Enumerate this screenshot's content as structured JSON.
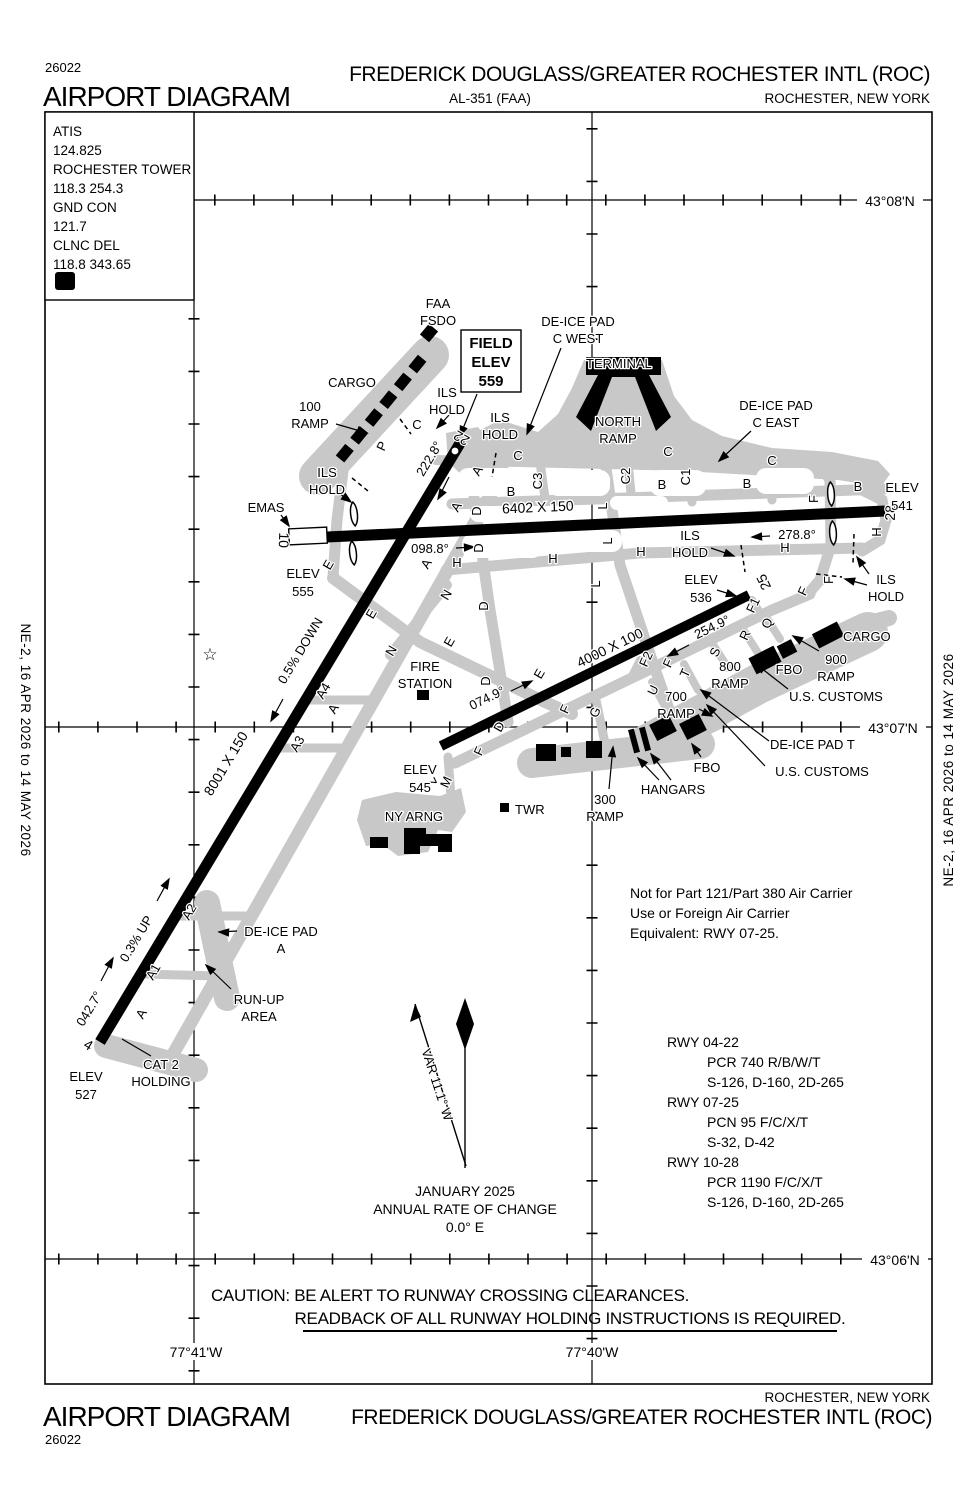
{
  "header": {
    "chart_number": "26022",
    "title": "AIRPORT DIAGRAM",
    "airport": "FREDERICK DOUGLASS/GREATER ROCHESTER INTL (ROC)",
    "al": "AL-351 (FAA)",
    "city": "ROCHESTER, NEW YORK"
  },
  "footer": {
    "chart_number": "26022",
    "title": "AIRPORT DIAGRAM",
    "airport": "FREDERICK DOUGLASS/GREATER ROCHESTER INTL (ROC)",
    "city": "ROCHESTER, NEW YORK"
  },
  "banner": "NE-2,  16 APR 2026  to  14 MAY 2026",
  "comm": {
    "lines": [
      "ATIS",
      "124.825",
      "ROCHESTER TOWER",
      "118.3  254.3",
      "GND CON",
      "121.7",
      "CLNC DEL",
      "118.8  343.65"
    ],
    "d": "D"
  },
  "grid": {
    "n08": "43°08'N",
    "n07": "43°07'N",
    "n06": "43°06'N",
    "w41": "77°41'W",
    "w40": "77°40'W"
  },
  "rwys": {
    "r0422": {
      "dim": "8001 X 150",
      "n_ne": "22",
      "n_sw": "4",
      "h_ne": "222.8°",
      "h_sw": "042.7°",
      "up": "0.3% UP",
      "down": "0.5% DOWN"
    },
    "r1028": {
      "dim": "6402  X 150",
      "n_w": "10",
      "n_e": "28",
      "h_e": "098.8°",
      "h_w": "278.8°"
    },
    "r0725": {
      "dim": "4000 X 100",
      "n_sw": "7",
      "n_ne": "25",
      "h_ne": "074.9°",
      "h_sw": "254.9°"
    }
  },
  "labels": {
    "faa": [
      "FAA",
      "FSDO"
    ],
    "field": [
      "FIELD",
      "ELEV",
      "559"
    ],
    "dicw": [
      "DE-ICE PAD",
      "C WEST"
    ],
    "dice": [
      "DE-ICE PAD",
      "C EAST"
    ],
    "dicea": [
      "DE-ICE PAD",
      "A"
    ],
    "dicet": "DE-ICE PAD T",
    "terminal": "TERMINAL",
    "nramp": [
      "NORTH",
      "RAMP"
    ],
    "cargo": "CARGO",
    "r100": [
      "100",
      "RAMP"
    ],
    "r300": [
      "300",
      "RAMP"
    ],
    "r700": [
      "700",
      "RAMP"
    ],
    "r800": [
      "800",
      "RAMP"
    ],
    "r900": [
      "900",
      "RAMP"
    ],
    "ils": [
      "ILS",
      "HOLD"
    ],
    "emas": "EMAS",
    "e555": [
      "ELEV",
      "555"
    ],
    "e541": [
      "ELEV",
      "541"
    ],
    "e536": [
      "ELEV",
      "536"
    ],
    "e545": [
      "ELEV",
      "545"
    ],
    "e527": [
      "ELEV",
      "527"
    ],
    "fire": [
      "FIRE",
      "STATION"
    ],
    "fbo": "FBO",
    "usc": "U.S. CUSTOMS",
    "hangars": "HANGARS",
    "twr": "TWR",
    "arng": "NY ARNG",
    "runup": [
      "RUN-UP",
      "AREA"
    ],
    "cat2": [
      "CAT 2",
      "HOLDING"
    ],
    "star": "☆"
  },
  "twy": {
    "A": "A",
    "A1": "A1",
    "A2": "A2",
    "A3": "A3",
    "A4": "A4",
    "B": "B",
    "C": "C",
    "C1": "C1",
    "C2": "C2",
    "C3": "C3",
    "D": "D",
    "E": "E",
    "F": "F",
    "F1": "F1",
    "F2": "F2",
    "G": "G",
    "H": "H",
    "L": "L",
    "M": "M",
    "N": "N",
    "P": "P",
    "Q": "Q",
    "R": "R",
    "S": "S",
    "T": "T",
    "U": "U"
  },
  "notes": [
    "Not for Part 121/Part 380 Air Carrier",
    "Use or Foreign Air Carrier",
    "Equivalent: RWY 07-25."
  ],
  "rwy_data": [
    "RWY 04-22",
    "PCR 740 R/B/W/T",
    "S-126, D-160, 2D-265",
    "RWY 07-25",
    "PCN 95 F/C/X/T",
    "S-32, D-42",
    "RWY 10-28",
    "PCR 1190 F/C/X/T",
    "S-126, D-160, 2D-265"
  ],
  "variation": {
    "label": "VAR 11.1° W",
    "date": "JANUARY 2025",
    "l2": "ANNUAL RATE OF CHANGE",
    "l3": "0.0° E"
  },
  "caution": {
    "l1": "CAUTION: BE ALERT TO RUNWAY CROSSING CLEARANCES.",
    "l2": "READBACK OF ALL RUNWAY HOLDING INSTRUCTIONS IS REQUIRED."
  },
  "colors": {
    "ink": "#000000",
    "taxiway": "#c8c8c8",
    "paper": "#ffffff"
  }
}
